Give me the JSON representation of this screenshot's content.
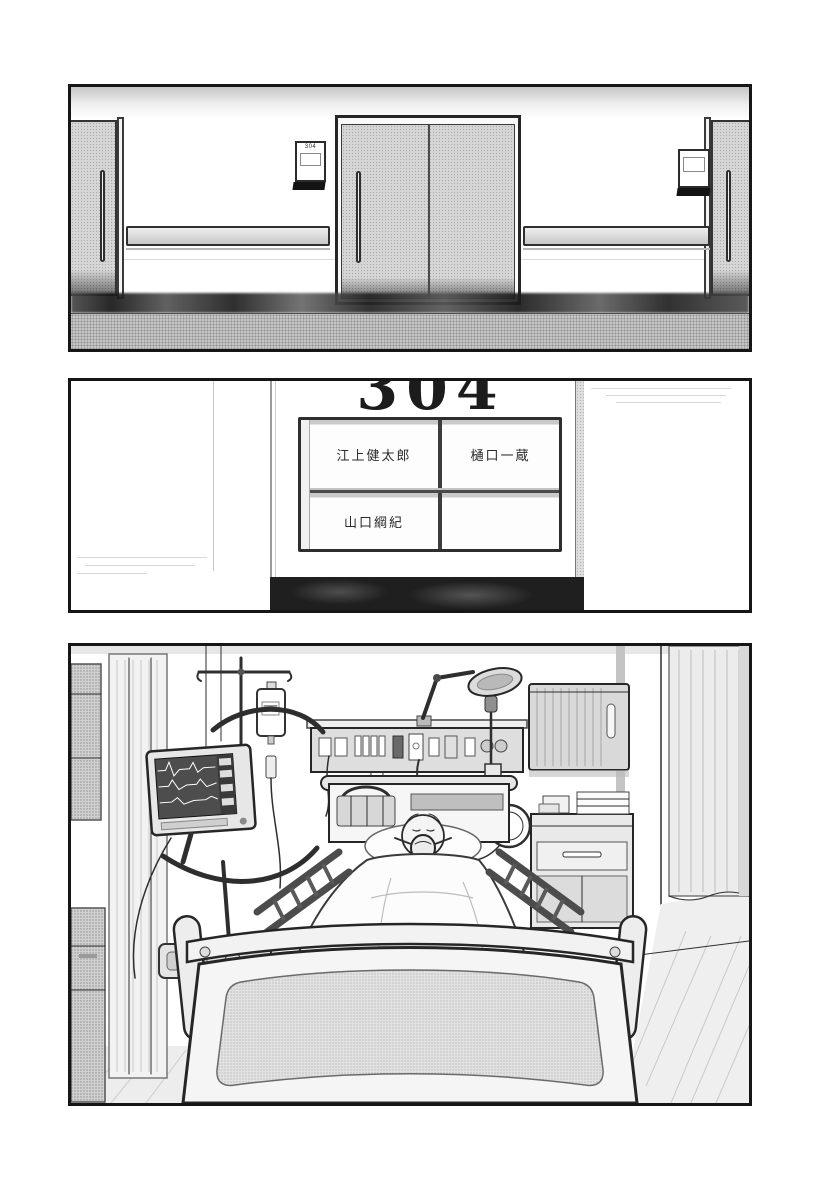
{
  "page": {
    "kind": "manga page, hospital scene, 3 borderless-gutter panels",
    "colors": {
      "ink": "#161616",
      "halftone_gray": "#d6d6d6",
      "floor_gray": "#c5c5c5",
      "shadow_dark": "#1f1f1f",
      "paper": "#ffffff"
    }
  },
  "panel_hallway": {
    "door_sign_number": "304"
  },
  "panel_sign_closeup": {
    "room_number": "304",
    "name_plates": [
      {
        "position": "top-left",
        "name": "江上健太郎"
      },
      {
        "position": "top-right",
        "name": "樋口一蔵"
      },
      {
        "position": "bottom-left",
        "name": "山口綱紀"
      },
      {
        "position": "bottom-right",
        "name": ""
      }
    ]
  },
  "panel_hospital_room": {
    "contents": "patient in bed wearing oxygen mask, vital-signs monitor cart, IV drip, wall medical console, exam light, cabinets, curtains"
  }
}
